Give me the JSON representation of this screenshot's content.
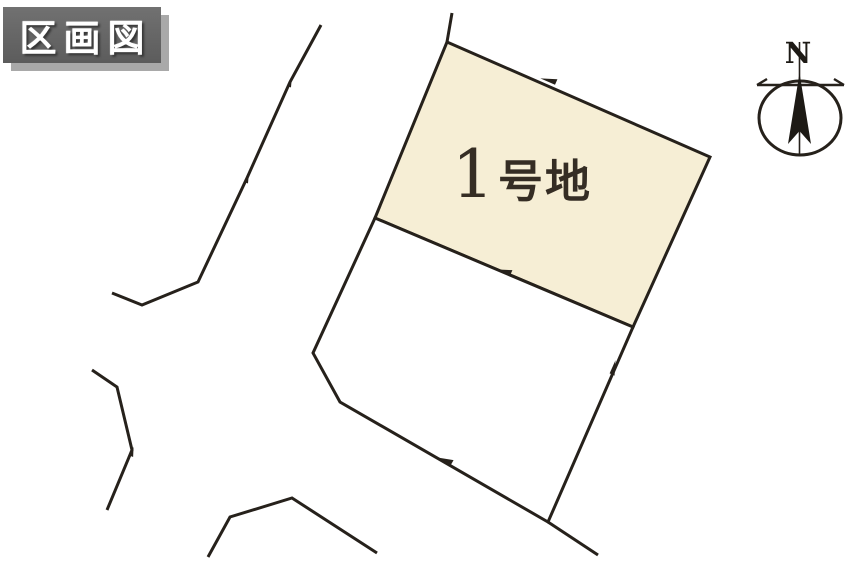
{
  "title_badge": {
    "label": "区画図"
  },
  "compass": {
    "label": "N"
  },
  "colors": {
    "background": "#ffffff",
    "line": "#26211b",
    "lot_fill": "#f6eed5",
    "badge_bg": "#666666",
    "badge_text": "#ffffff",
    "label_text": "#352d24"
  },
  "parcels": [
    {
      "id": "lot-1",
      "number": "1",
      "suffix": "号地",
      "label": "1号地",
      "fill": "#f6eed5",
      "points": [
        [
          447,
          42
        ],
        [
          710,
          157
        ],
        [
          633,
          327
        ],
        [
          375,
          218
        ]
      ]
    },
    {
      "id": "lot-2",
      "fill": "#ffffff",
      "points": [
        [
          375,
          218
        ],
        [
          633,
          327
        ],
        [
          548,
          522
        ],
        [
          340,
          402
        ],
        [
          313,
          353
        ]
      ]
    }
  ],
  "road_lines": [
    {
      "id": "road-west",
      "points": [
        [
          321,
          25
        ],
        [
          290,
          82
        ],
        [
          247,
          178
        ],
        [
          198,
          282
        ],
        [
          142,
          305
        ],
        [
          112,
          293
        ]
      ]
    },
    {
      "id": "road-southwest",
      "points": [
        [
          92,
          370
        ],
        [
          117,
          387
        ],
        [
          132,
          450
        ],
        [
          107,
          510
        ]
      ]
    },
    {
      "id": "road-south",
      "points": [
        [
          208,
          557
        ],
        [
          230,
          517
        ],
        [
          292,
          498
        ],
        [
          377,
          553
        ]
      ]
    },
    {
      "id": "boundary-extension-north",
      "points": [
        [
          452,
          13
        ],
        [
          447,
          42
        ]
      ]
    },
    {
      "id": "boundary-extension-south",
      "points": [
        [
          548,
          522
        ],
        [
          598,
          555
        ]
      ]
    }
  ],
  "boundary_marks": [
    {
      "x": 549,
      "y": 81,
      "angle": 23.6,
      "scale": 1
    },
    {
      "x": 504,
      "y": 272,
      "angle": 23,
      "scale": 1
    },
    {
      "x": 613,
      "y": 368,
      "angle": 114,
      "scale": 0.9
    },
    {
      "x": 445,
      "y": 461,
      "angle": 30,
      "scale": 1
    },
    {
      "x": 290,
      "y": 82,
      "angle": 115.6,
      "scale": 0.65
    },
    {
      "x": 247,
      "y": 178,
      "angle": 115.6,
      "scale": 0.65
    },
    {
      "x": 132,
      "y": 452,
      "angle": 113,
      "scale": 0.6
    }
  ]
}
